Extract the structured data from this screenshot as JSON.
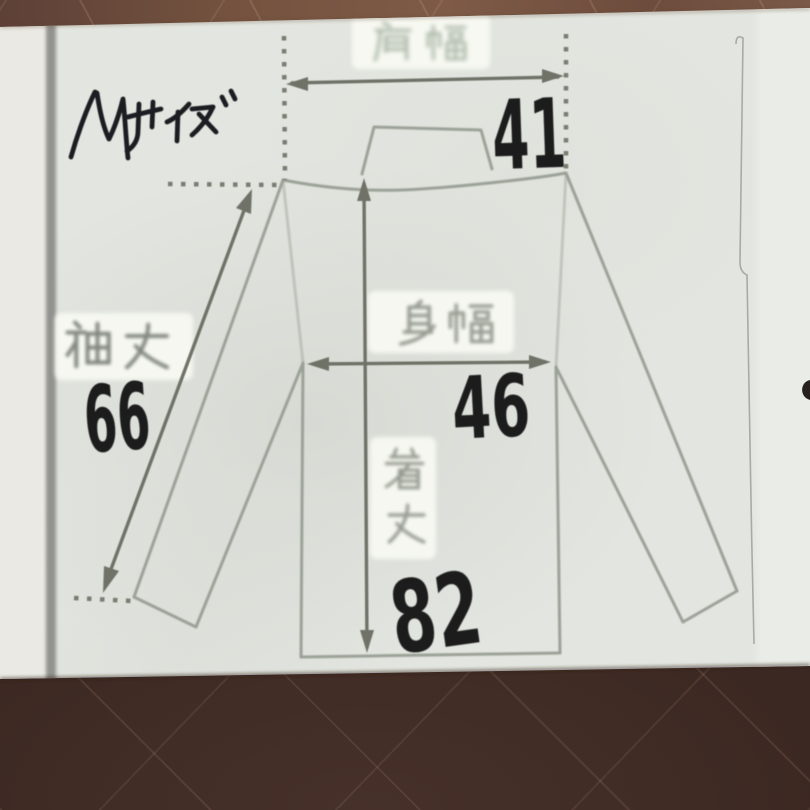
{
  "page": {
    "size_label": "Mサイズ",
    "measurements": {
      "shoulder_width": {
        "label": "肩幅",
        "value": "41"
      },
      "body_width": {
        "label": "身幅",
        "value": "46"
      },
      "sleeve_length": {
        "label": "袖丈",
        "value": "66"
      },
      "body_length": {
        "label": "着丈",
        "value": "82"
      }
    },
    "colors": {
      "floor_dark": "#3c2822",
      "floor_light": "#7a5848",
      "paper": "#e3e6e0",
      "print_line": "#9aa096",
      "arrow_ink": "#6f7268",
      "marker_ink": "#1e1e20",
      "label_green": "#93a18f"
    }
  }
}
